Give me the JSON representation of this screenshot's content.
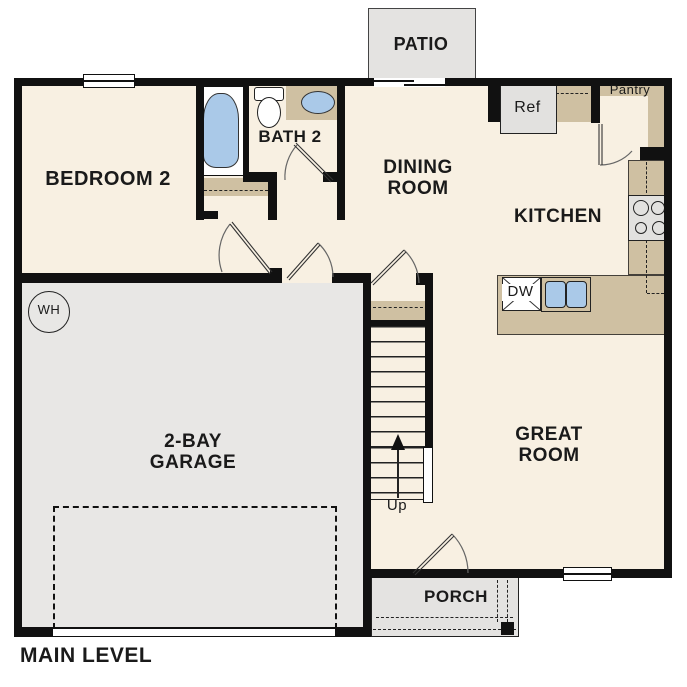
{
  "title": "MAIN LEVEL",
  "rooms": {
    "patio": "PATIO",
    "bedroom2": "BEDROOM 2",
    "bath2": "BATH 2",
    "dining": "DINING\nROOM",
    "kitchen": "KITCHEN",
    "pantry": "Pantry",
    "garage": "2-BAY\nGARAGE",
    "great": "GREAT\nROOM",
    "porch": "PORCH"
  },
  "fixtures": {
    "ref": "Ref",
    "dw": "DW",
    "water_heater": "WH",
    "stairs_up": "Up"
  },
  "colors": {
    "wall": "#111111",
    "floor_cream": "#f8f0e2",
    "floor_gray": "#e8e7e5",
    "counter_tan": "#cfc0a2",
    "fixture_blue": "#aac9e8",
    "outside": "#ffffff"
  }
}
